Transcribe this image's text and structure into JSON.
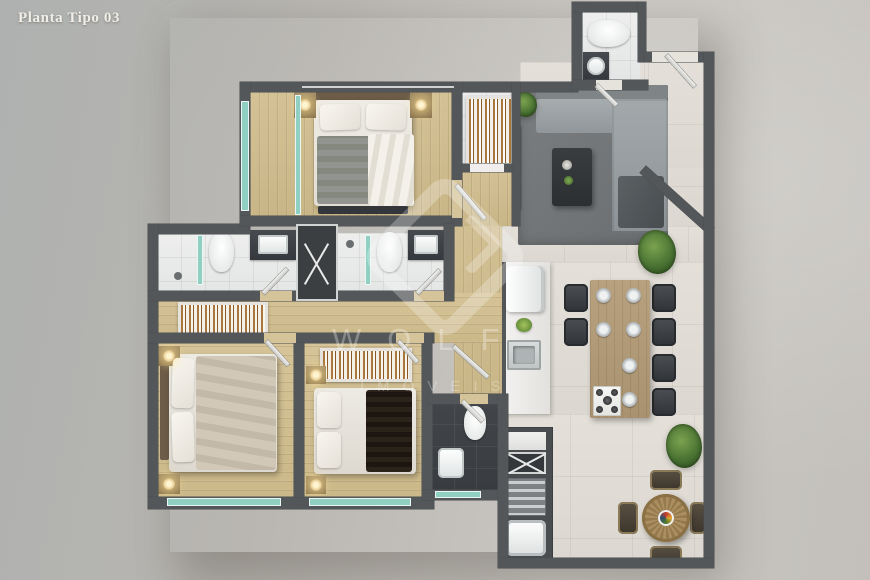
{
  "title": "Planta Tipo 03",
  "watermark": {
    "brand": "WOLF",
    "tagline": "IMÓVEIS",
    "logo": "wolf-diamond-logo"
  },
  "colors": {
    "background_left": "#aeb1b0",
    "background_right": "#c9c6c1",
    "walls": "#54575a",
    "wood_floor": "#d4c296",
    "tile_floor": "#e4e0d9",
    "bathroom_floor": "#edeeed",
    "service_dark_floor": "#42464a",
    "glass_accent": "#8fd0c2",
    "rug": "#75787a",
    "sofa": "#9aa0a3",
    "island_wood": "#b29c7b",
    "plant_green": "#477031",
    "title_text": "#f1eee8"
  }
}
